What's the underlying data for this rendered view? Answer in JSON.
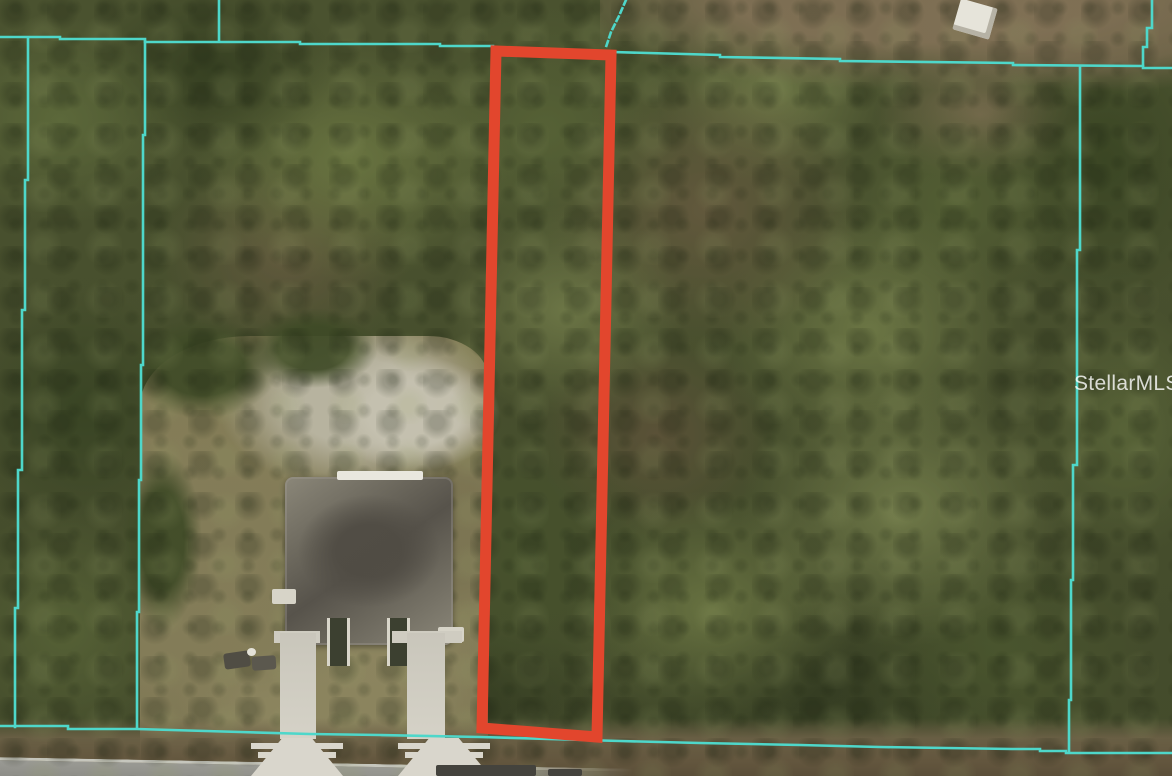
{
  "watermark": {
    "text": "StellarMLS"
  },
  "colors": {
    "parcel_line": "#4ed7ca",
    "highlight_outline": "#e2462d"
  }
}
